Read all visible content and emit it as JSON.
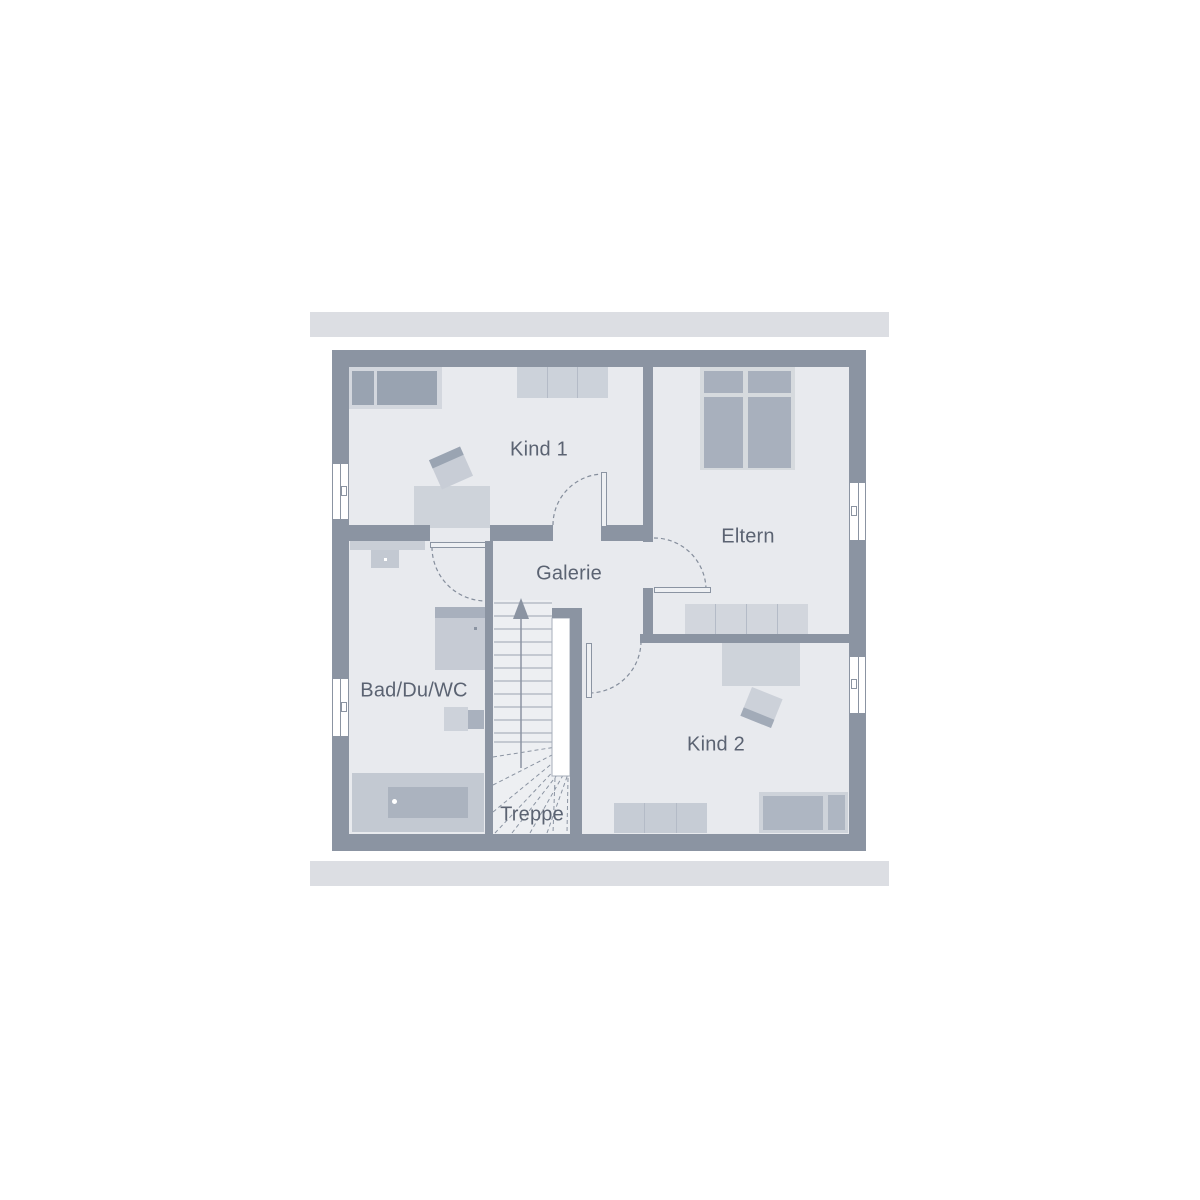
{
  "floorplan": {
    "rooms": [
      {
        "id": "kind1",
        "label": "Kind 1",
        "label_x": 539,
        "label_y": 450
      },
      {
        "id": "eltern",
        "label": "Eltern",
        "label_x": 748,
        "label_y": 537
      },
      {
        "id": "galerie",
        "label": "Galerie",
        "label_x": 569,
        "label_y": 574
      },
      {
        "id": "bad",
        "label": "Bad/Du/WC",
        "label_x": 414,
        "label_y": 691
      },
      {
        "id": "kind2",
        "label": "Kind 2",
        "label_x": 716,
        "label_y": 745
      },
      {
        "id": "treppe",
        "label": "Treppe",
        "label_x": 532,
        "label_y": 815
      }
    ],
    "colors": {
      "wall": "#8b94a2",
      "floor": "#e8eaee",
      "roof_bar": "#dcdee3",
      "furniture_light": "#ced3da",
      "furniture_dark": "#a8b0bd",
      "stair_tread_line": "#9aa3b0",
      "door_swing_dash": "#858e9c",
      "label_text": "#5b6372"
    }
  }
}
